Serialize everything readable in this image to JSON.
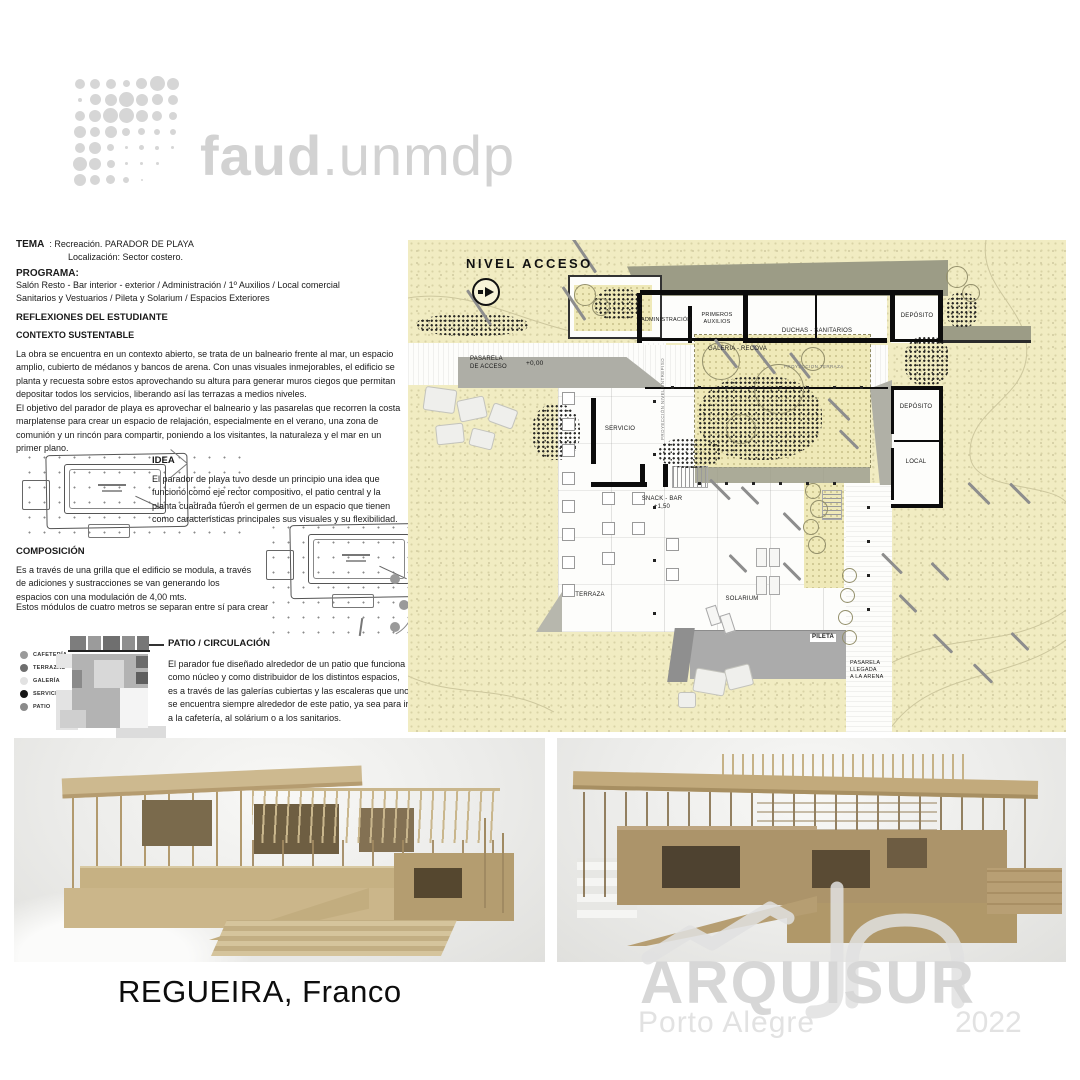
{
  "logo": {
    "name_bold": "faud",
    "name_light": ".unmdp",
    "dot_color": "#d6d6d6",
    "dot_rows": [
      [
        10,
        10,
        10,
        7,
        11,
        15,
        12
      ],
      [
        4,
        11,
        12,
        15,
        12,
        11,
        10
      ],
      [
        10,
        12,
        15,
        15,
        12,
        10,
        8
      ],
      [
        12,
        10,
        12,
        8,
        7,
        6,
        6
      ],
      [
        10,
        12,
        7,
        3,
        5,
        4,
        3
      ],
      [
        14,
        12,
        8,
        3,
        3,
        3,
        0
      ],
      [
        12,
        10,
        9,
        6,
        2,
        0,
        0
      ]
    ]
  },
  "left_column": {
    "tema_label": "TEMA",
    "tema_line1": ": Recreación. PARADOR DE PLAYA",
    "tema_line2": "Localización: Sector costero.",
    "programa_label": "PROGRAMA:",
    "programa_line1": "Salón Resto - Bar  interior - exterior / Administración  /  1º Auxilios  / Local comercial",
    "programa_line2": "Sanitarios y Vestuarios  /  Pileta y Solarium   /  Espacios Exteriores",
    "reflexiones_title": "REFLEXIONES DEL ESTUDIANTE",
    "contexto_title": "CONTEXTO SUSTENTABLE",
    "contexto_p1": "La obra se encuentra en un contexto abierto, se trata de un balneario frente al mar, un espacio amplio, cubierto de médanos y bancos de arena. Con unas visuales inmejorables, el edificio se planta y recuesta sobre estos aprovechando su altura para generar muros ciegos que permitan depositar todos los servicios, liberando así las terrazas a medios niveles.",
    "contexto_p2": "El objetivo del parador de playa es aprovechar el balneario y las pasarelas que recorren la costa marplatense para crear un espacio de relajación, especialmente en el verano, una zona de comunión y un rincón para compartir, poniendo a los visitantes, la naturaleza y el mar en un primer plano.",
    "idea_title": "IDEA",
    "idea_text": "El parador de playa tuvo desde un principio una idea que funcionó como eje rector compositivo, el patio central y la planta cuadrada fueron el germen de un espacio que tienen como características principales sus visuales y su flexibilidad.",
    "composicion_title": "COMPOSICIÓN",
    "composicion_text1": "Es a través de una grilla que el edificio se modula, a través de adiciones y sustracciones se van generando los espacios con una modulación de 4,00 mts.",
    "composicion_text2": "Estos módulos de cuatro metros se separan entre sí para crear",
    "patio_title": "PATIO / CIRCULACIÓN",
    "patio_text": "El parador fue diseñado alrededor de un patio que funciona como núcleo y como distribuidor de los distintos espacios, es a través de las galerías cubiertas y las escaleras que uno se encuentra siempre alrededor de este patio, ya sea para ir a la cafetería, al solárium o a los sanitarios.",
    "legend": [
      {
        "label": "CAFETERÍA",
        "color": "#9a9a9a"
      },
      {
        "label": "TERRAZAS",
        "color": "#6e6e6e"
      },
      {
        "label": "GALERÍA",
        "color": "#e2e2e2"
      },
      {
        "label": "SERVICIOS",
        "color": "#161616"
      },
      {
        "label": "PATIO",
        "color": "#8b8b8b"
      }
    ]
  },
  "plan": {
    "labels": {
      "nivel_acceso": "NIVEL  ACCESO",
      "pasarela_acceso": "PASARELA\nDE ACCESO",
      "cota_acceso": "+0,00",
      "administracion": "ADMINISTRACIÓN",
      "primeros_auxilios": "PRIMEROS\nAUXILIOS",
      "duchas": "DUCHAS - SANITARIOS",
      "deposito1": "DEPÓSITO",
      "galeria": "GALERIA - RECOVA",
      "proyeccion_terraza": "PROYECCION TERRAZA",
      "proyeccion_entrepiso": "PROYECCIÓN NIVEL ENTREPISO",
      "deposito2": "DEPÓSITO",
      "local": "LOCAL",
      "servicio": "SERVICIO",
      "snack": "SNACK - BAR\n+1,50",
      "terraza": "TERRAZA",
      "solarium": "SOLARIUM",
      "pileta": "PILETA",
      "pasarela_llegada": "PASARELA\nLLEGADA\nA LA ARENA"
    },
    "colors": {
      "sand": "#f1ecc2",
      "roof": "#9c9c86",
      "pool": "#ababab"
    }
  },
  "footer": {
    "student_name": "REGUEIRA, Franco"
  },
  "watermark": {
    "title": "ARQUISUR",
    "subtitle": "Porto Alegre",
    "year": "2022"
  }
}
